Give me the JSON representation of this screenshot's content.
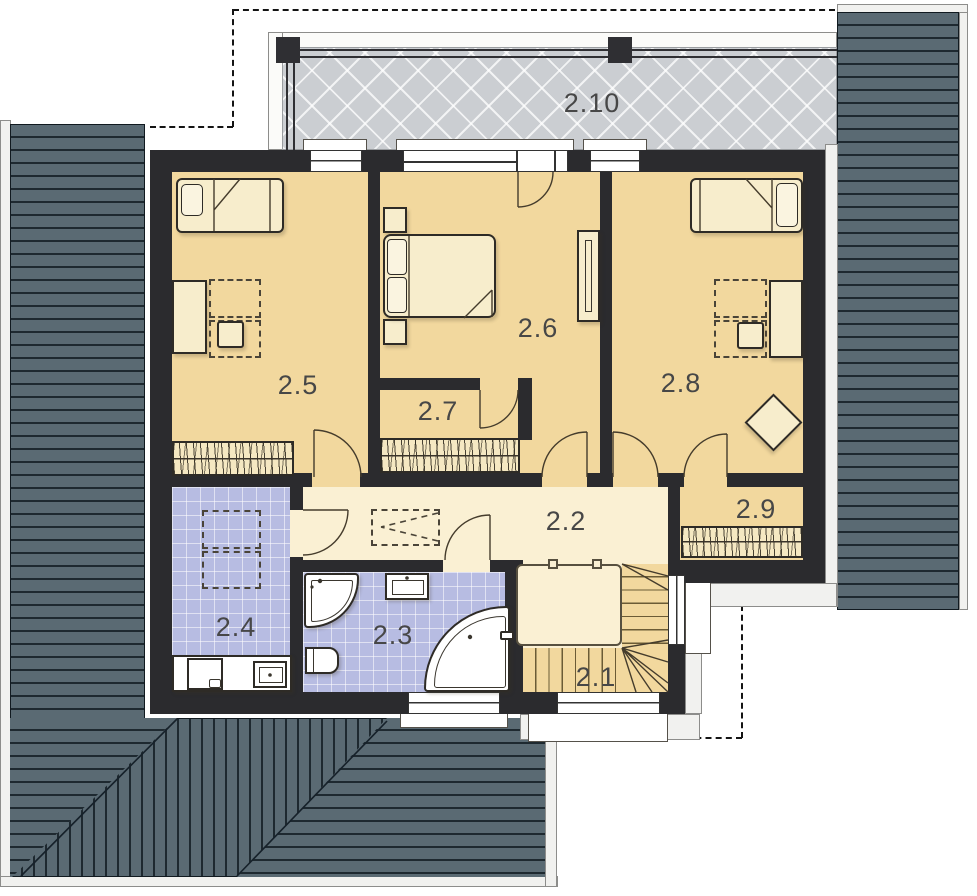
{
  "title": "Upper floor plan",
  "rooms": {
    "r21": {
      "label": "2.1",
      "type": "staircase"
    },
    "r22": {
      "label": "2.2",
      "type": "hallway"
    },
    "r23": {
      "label": "2.3",
      "type": "bathroom"
    },
    "r24": {
      "label": "2.4",
      "type": "bathroom-laundry"
    },
    "r25": {
      "label": "2.5",
      "type": "bedroom"
    },
    "r26": {
      "label": "2.6",
      "type": "bedroom"
    },
    "r27": {
      "label": "2.7",
      "type": "walk-in-closet"
    },
    "r28": {
      "label": "2.8",
      "type": "bedroom"
    },
    "r29": {
      "label": "2.9",
      "type": "walk-in-closet"
    },
    "r210": {
      "label": "2.10",
      "type": "terrace"
    }
  },
  "symbols": [
    "single-bed",
    "double-bed",
    "desk",
    "chair",
    "wardrobe",
    "shower",
    "washbasin",
    "toilet",
    "corner-bathtub",
    "washing-machine",
    "stairs",
    "railing",
    "roof",
    "terrace-railing"
  ],
  "colors": {
    "wall": "#2b2b2e",
    "bedroom": "#f2d89e",
    "hall": "#faf0d3",
    "bath": "#b7bce2",
    "roof": "#5a6a73",
    "roofline": "#1e2930",
    "terrace": "#cbced2",
    "furn": "#f7edcc",
    "pillow": "#faf4e0",
    "outline": "#2e2b26",
    "label": "#474747"
  }
}
